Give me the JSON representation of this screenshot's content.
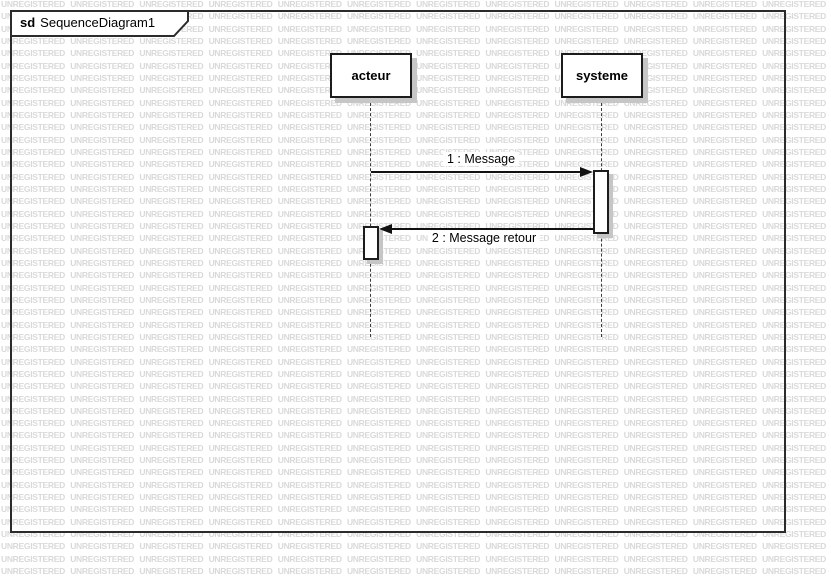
{
  "frame": {
    "keyword": "sd",
    "title": "SequenceDiagram1"
  },
  "lifelines": [
    {
      "name": "acteur"
    },
    {
      "name": "systeme"
    }
  ],
  "messages": [
    {
      "label": "1 : Message",
      "from": "acteur",
      "to": "systeme",
      "direction": "right"
    },
    {
      "label": "2 : Message retour",
      "from": "systeme",
      "to": "acteur",
      "direction": "left"
    }
  ],
  "watermark": {
    "text": "UNREGISTERED",
    "color": "#d9d9d9"
  },
  "colors": {
    "background": "#ffffff",
    "frame_border": "#2b2b2b",
    "shape_border": "#1c1c1c",
    "shadow": "#c6c6c6",
    "message_line": "#111111",
    "text": "#000000"
  }
}
